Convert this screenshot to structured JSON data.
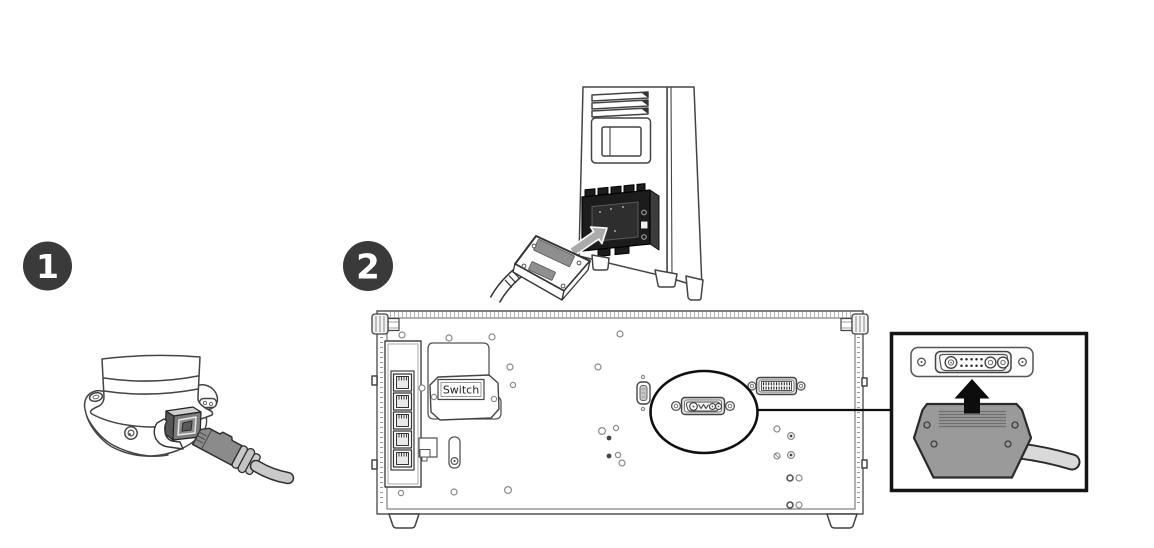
{
  "steps": [
    {
      "badge": "1"
    },
    {
      "badge": "2"
    }
  ],
  "rack": {
    "switch_label": "Switch"
  },
  "icons": {
    "insert_arrow": "➔",
    "up_arrow": "▲"
  },
  "colors": {
    "badge_fill": "#3a3a3a",
    "badge_text": "#ffffff",
    "line_art": "#444444",
    "connector_block": "#1c1c1c",
    "plug_gray": "#8b8b8b",
    "cable_gray": "#c9c9c9",
    "hood_gray": "#9a9a9a",
    "inset_border": "#141414"
  }
}
